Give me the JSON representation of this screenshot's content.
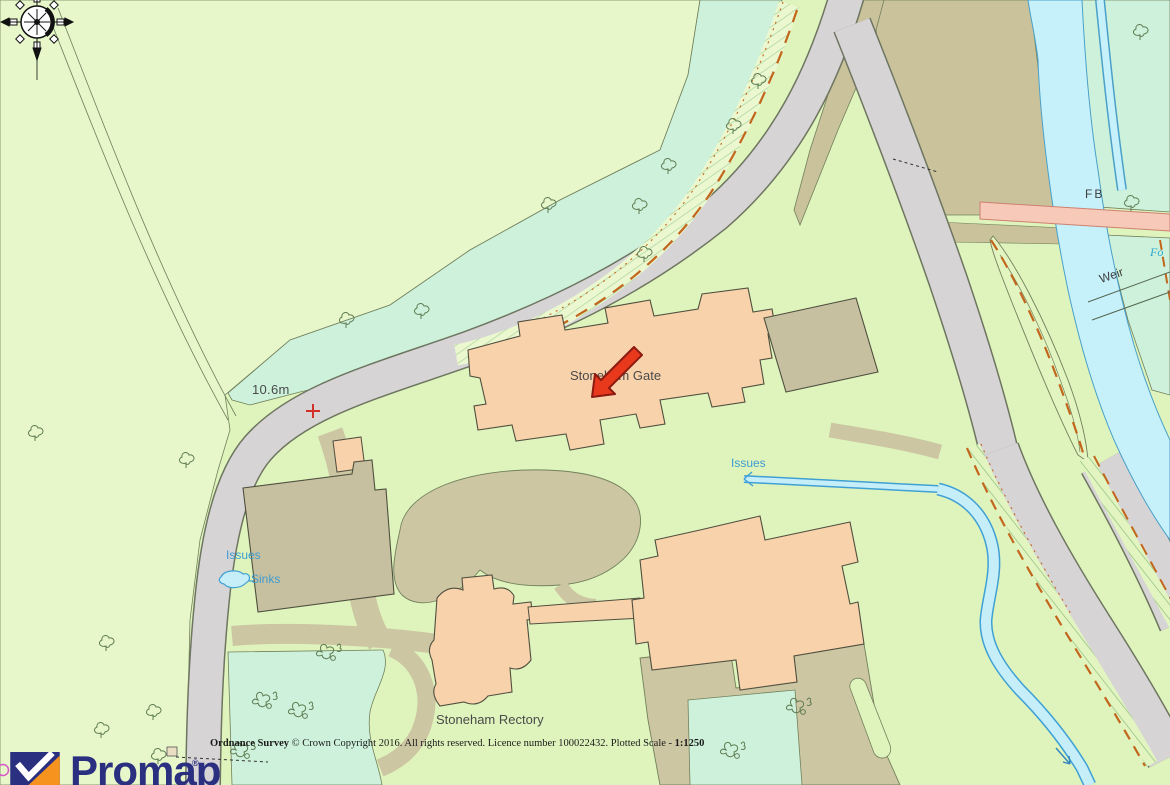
{
  "attribution": {
    "publisher": "Ordnance Survey",
    "notice": " © Crown Copyright 2016. All rights reserved. Licence number 100022432. Plotted Scale - ",
    "scale": "1:1250"
  },
  "branding": {
    "logo_text": "Promap",
    "registered_mark": "®"
  },
  "map_labels": {
    "spot_height": "10.6m",
    "issues_west": "Issues",
    "sinks": "Sinks",
    "issues_east": "Issues",
    "footbridge_abbrev": "FB",
    "weir": "Weir",
    "water_label_partial": "Fo",
    "building_stoneham_gate": "Stoneham Gate",
    "building_stoneham_rectory": "Stoneham Rectory"
  },
  "colors": {
    "field_green": "#E7F7CA",
    "grounds_green": "#DFF4BC",
    "scrub_mint": "#CDF1DA",
    "road_grey": "#D6D4D5",
    "vegetation_tan": "#C9C29B",
    "driveway_tan": "#CCC6A3",
    "building_peach": "#F8D2AA",
    "building_tan": "#C6C0A0",
    "water_cyan": "#C6F1FB",
    "stream_blue_edge": "#3FA0D4",
    "footbridge_pink": "#F6C9B9",
    "verge_dash_orange": "#C2661C",
    "marker_red": "#E8391D",
    "water_label_blue": "#3E9CD2",
    "logo_navy": "#2A2F7F",
    "logo_orange": "#F6921E"
  },
  "icons": {
    "compass-rose-icon": "compass rose, north arrow",
    "map-marker-arrow-icon": "red arrow pointing south-west",
    "spot-height-cross-icon": "+",
    "tree-icon": "deciduous tree outline",
    "bush-icon": "scrub bush outline",
    "flow-arrow-icon": "stream flow arrow",
    "promap-logo-icon": "navy/orange square with white check"
  }
}
